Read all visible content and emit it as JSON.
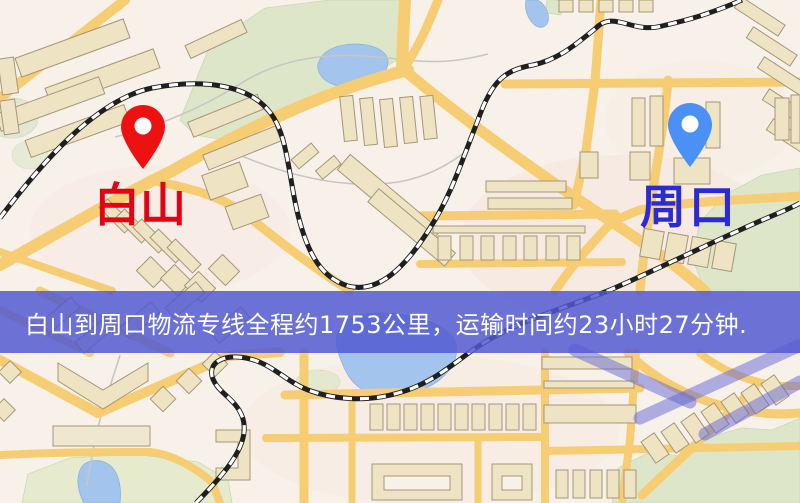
{
  "banner": {
    "text": "白山到周口物流专线全程约1753公里，运输时间约23小时27分钟.",
    "overlay_rgba": "rgba(81,88,210,0.84)",
    "text_color": "#ffffff"
  },
  "markers": {
    "origin": {
      "label": "白山",
      "label_color": "#e60012",
      "pin_color": "#ee1111",
      "pin_icon": "map-pin"
    },
    "destination": {
      "label": "周口",
      "label_color": "#2b2bd5",
      "pin_color": "#4a90f5",
      "pin_icon": "map-pin"
    }
  },
  "map": {
    "style": "street-map",
    "features": {
      "road_color": "#f6cd72",
      "park_color": "#dde6c9",
      "water_color": "#a3c4ec",
      "building_color": "#eee4c4",
      "railway_base_color": "#1f1f1f",
      "railway_dash_color": "#ffffff",
      "expressway_band_color": "#6266d6"
    }
  }
}
